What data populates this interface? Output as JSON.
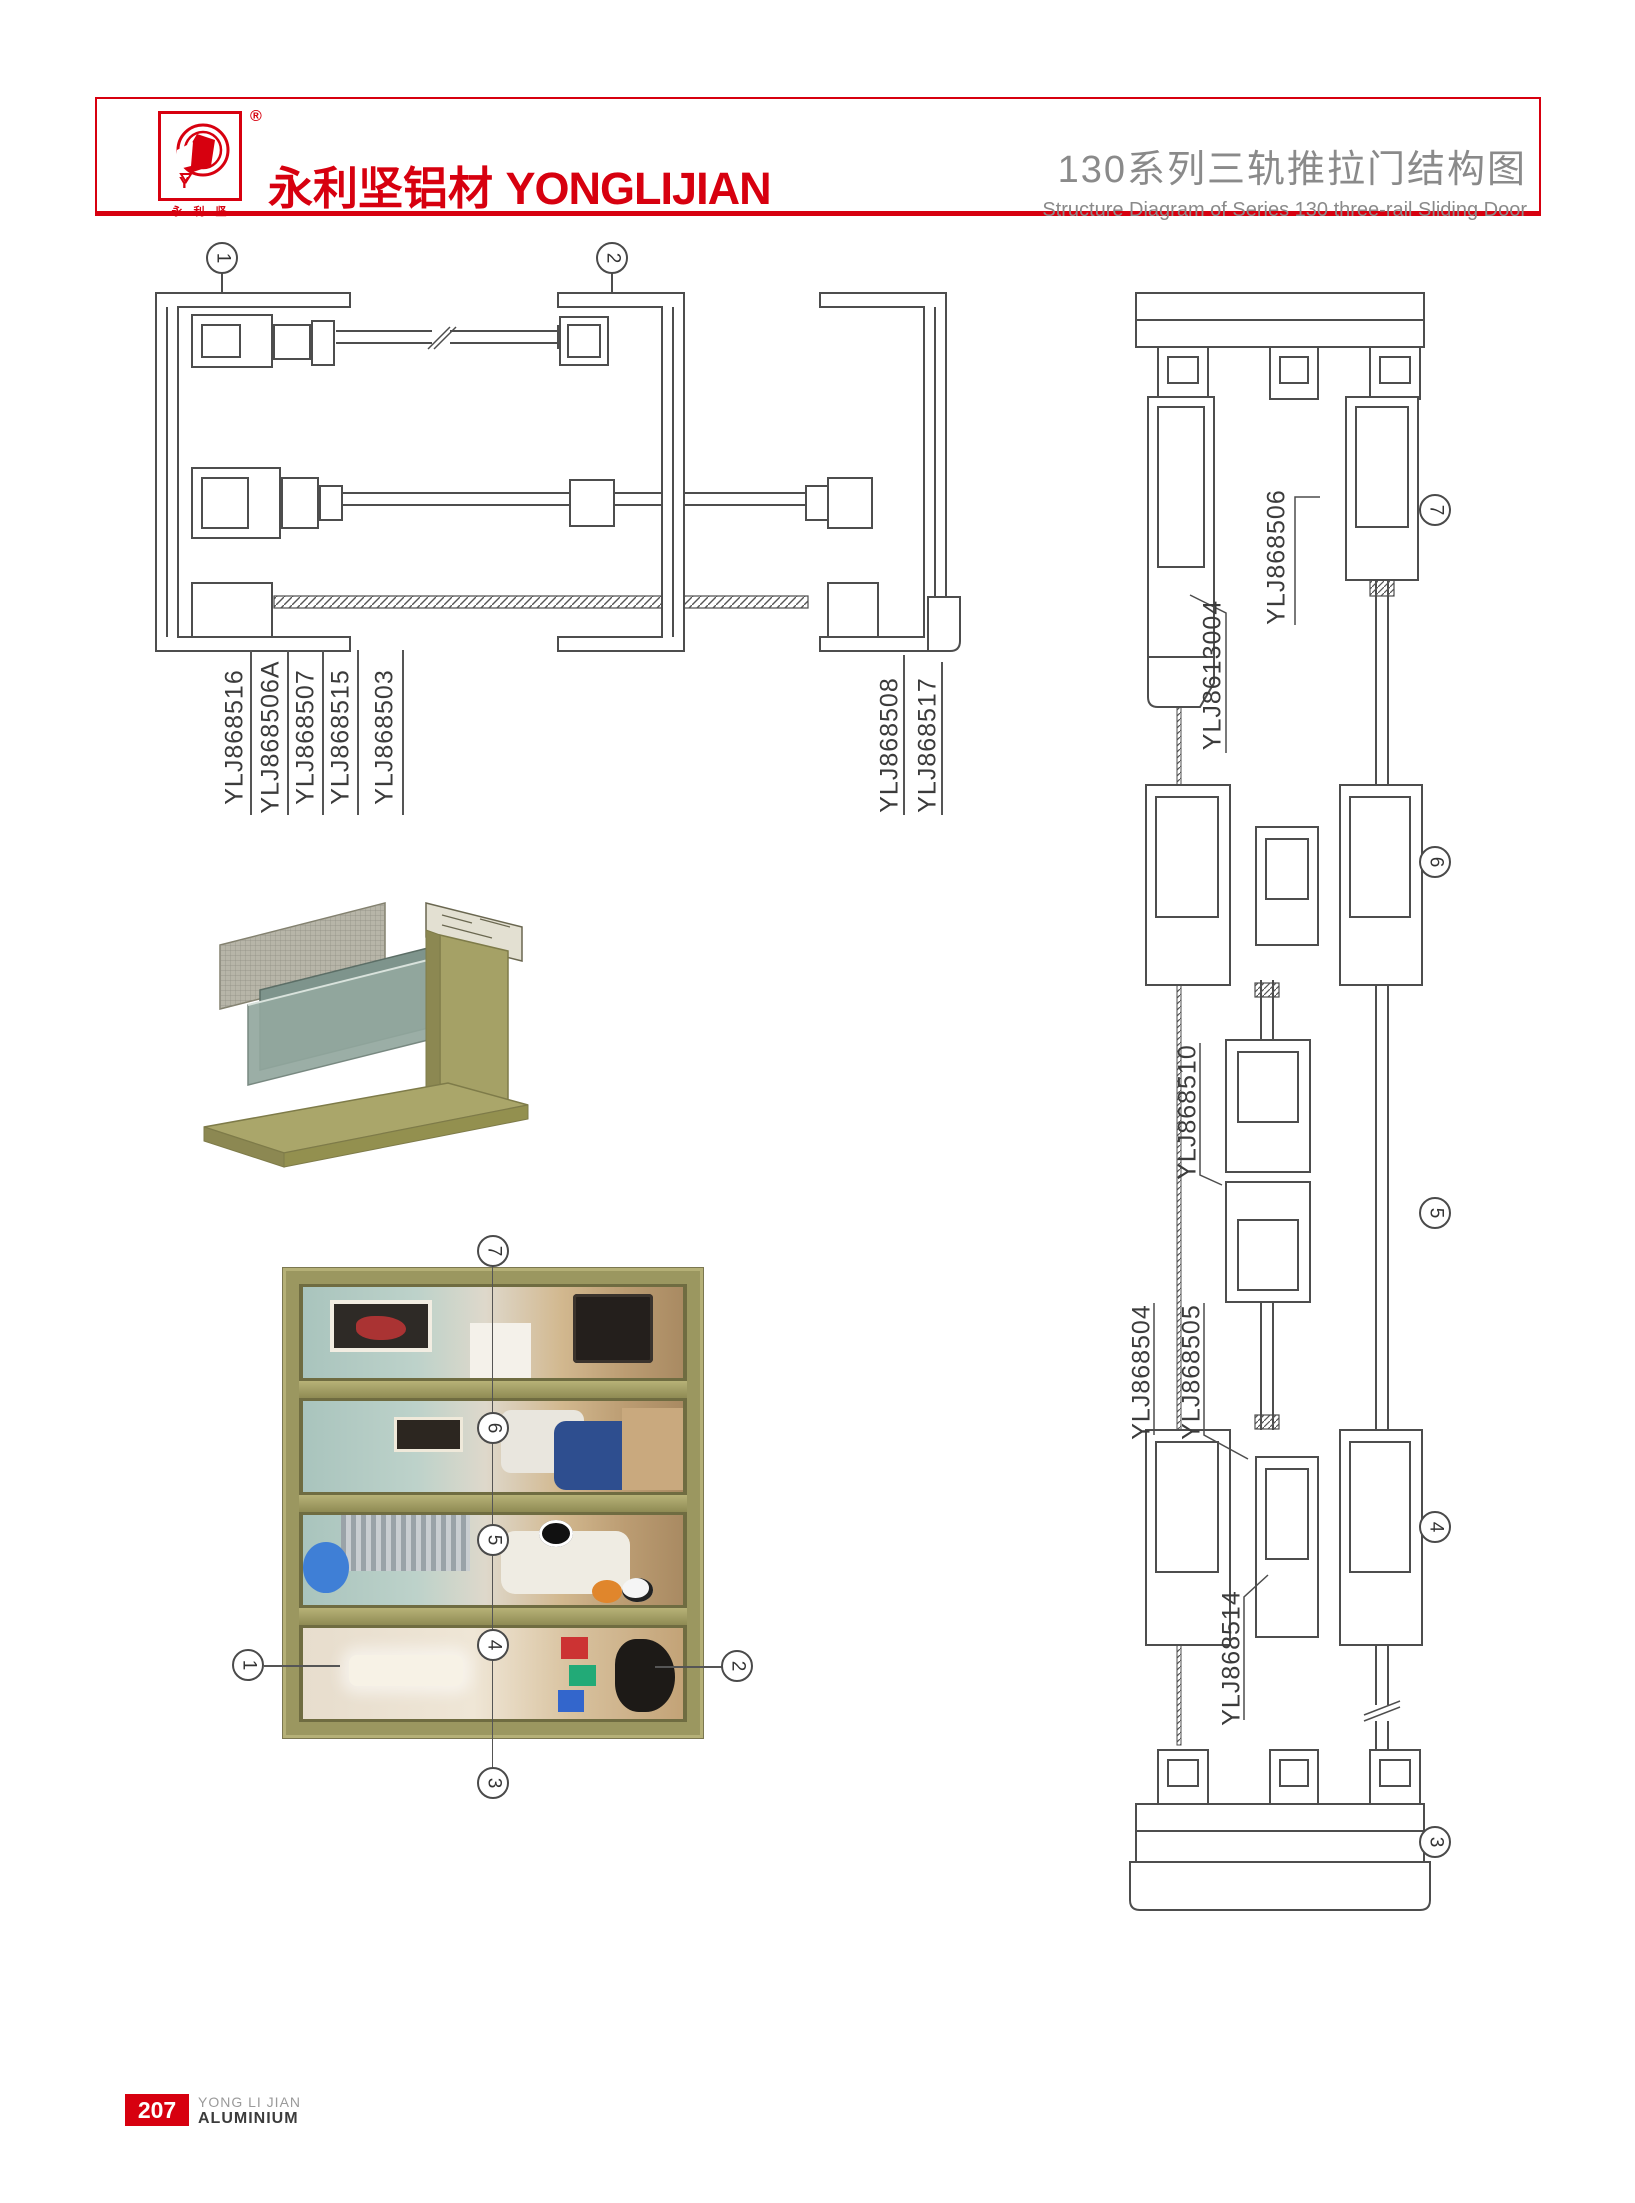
{
  "header": {
    "accent": "#d7000f",
    "logo": {
      "monogram": "Y",
      "registered": "®",
      "subtext": "永 利 坚"
    },
    "brand_cn": "永利坚铝材",
    "brand_en": "YONGLIJIAN",
    "title_cn": "130系列三轨推拉门结构图",
    "title_en": "Structure Diagram of Series 130 three-rail Sliding Door"
  },
  "plan_section": {
    "callout_1": "1",
    "callout_2": "2",
    "labels_left": [
      "YLJ868516",
      "YLJ868506A",
      "YLJ868507",
      "YLJ868515",
      "YLJ868503"
    ],
    "labels_right": [
      "YLJ868508",
      "YLJ868517"
    ]
  },
  "vertical_section": {
    "callout_7": "7",
    "callout_6": "6",
    "callout_5": "5",
    "callout_4": "4",
    "callout_3": "3",
    "label_head": "YLJ868506",
    "label_head2": "YLJ8613004",
    "label_mid": "YLJ868510",
    "label_low1": "YLJ868504",
    "label_low2": "YLJ868505",
    "label_low3": "YLJ868514"
  },
  "photo_callouts": {
    "top": "7",
    "mid1": "6",
    "mid2": "5",
    "mid3": "4",
    "bottom": "3",
    "left": "1",
    "right": "2"
  },
  "footer": {
    "page_number": "207",
    "brand_line1": "YONG LI JIAN",
    "brand_line2": "ALUMINIUM"
  }
}
